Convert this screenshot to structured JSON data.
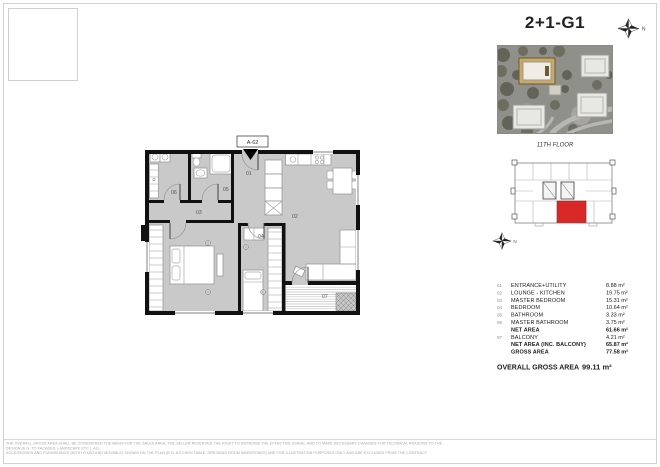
{
  "header": {
    "title": "2+1-G1"
  },
  "compass": {
    "north_label": "N"
  },
  "keyplan": {
    "floor_label": "11TH FLOOR"
  },
  "plan": {
    "unit_label": "A-62",
    "labels": {
      "r01": "01",
      "r02": "02",
      "r03": "03",
      "r04": "04",
      "r05": "05",
      "r06": "06",
      "r07": "07"
    }
  },
  "schedule": {
    "rows": [
      {
        "num": "01",
        "name": "ENTRANCE+UTILITY",
        "value": "8.88 m²",
        "bold": false
      },
      {
        "num": "02",
        "name": "LOUNGE - KITCHEN",
        "value": "19.75 m²",
        "bold": false
      },
      {
        "num": "03",
        "name": "MASTER BEDROOM",
        "value": "15.31 m²",
        "bold": false
      },
      {
        "num": "04",
        "name": "BEDROOM",
        "value": "10.64 m²",
        "bold": false
      },
      {
        "num": "05",
        "name": "BATHROOM",
        "value": "3.33 m²",
        "bold": false
      },
      {
        "num": "06",
        "name": "MASTER BATHROOM",
        "value": "3.75 m²",
        "bold": false
      },
      {
        "num": "",
        "name": "NET AREA",
        "value": "61.66 m²",
        "bold": true
      },
      {
        "num": "07",
        "name": "BALCONY",
        "value": "4.21 m²",
        "bold": false
      },
      {
        "num": "",
        "name": "NET AREA (INC. BALCONY)",
        "value": "65.87 m²",
        "bold": true
      },
      {
        "num": "",
        "name": "GROSS AREA",
        "value": "77.58 m²",
        "bold": true
      }
    ],
    "overall": {
      "name": "OVERALL GROSS AREA",
      "value": "99.11 m²"
    }
  },
  "footer": {
    "line1": "THE OVERALL GROSS AREA SHALL BE CONSIDERED THE BASIS FOR THE SALES AREA. THE SELLER RESERVED THE RIGHT TO INCREASE THE EFFECTIVE USAGE, AND TO MAKE NECESSARY CHANGES FOR TECHNICAL REASONS TO THE DESIGN (E.G. TO FACADES, LANDSCAPE ETC.). ALL",
    "line2": "ACCESSORIES AND FURNISHINGS (BOTH FIXED AND MOVABLE) SHOWN ON THE PLAN (E.G. KITCHEN TABLE, DRESSING ROOM WARDROBES) ARE FOR ILLUSTRATION PURPOSES ONLY AND ARE EXCLUDED FROM THE CONTRACT"
  },
  "colors": {
    "highlight_red": "#d92828",
    "floor_fill": "#c9c9c9",
    "accent_tan": "#c8a968",
    "wall_black": "#111111"
  }
}
